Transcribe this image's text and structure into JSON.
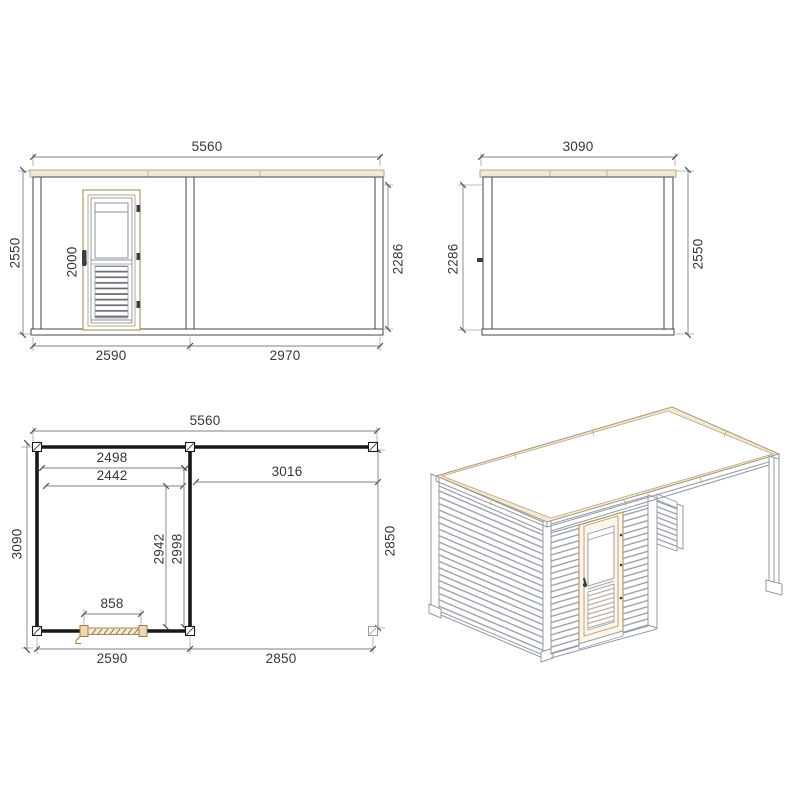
{
  "drawing": {
    "type": "technical-plan-sheet",
    "subject": "garden cabin with side pergola",
    "views": [
      "front-elevation",
      "side-elevation",
      "floor-plan",
      "isometric-view"
    ]
  },
  "front": {
    "width_total": "5560",
    "height_left": "2550",
    "height_right": "2286",
    "door_height": "2000",
    "bottom_left": "2590",
    "bottom_right": "2970"
  },
  "side": {
    "width_total": "3090",
    "height_left": "2286",
    "height_right": "2550"
  },
  "plan": {
    "width_total": "5560",
    "inner_width_1": "2498",
    "inner_width_2": "2442",
    "open_span": "3016",
    "depth_left": "3090",
    "inner_depth_1": "2942",
    "inner_depth_2": "2998",
    "depth_right": "2850",
    "door_width": "858",
    "bottom_left": "2590",
    "bottom_right": "2850"
  },
  "colors": {
    "slat_dark": "#40454b",
    "dimension_text": "#34373c",
    "dimension_line": "#7d828a",
    "wood_tan_fill": "#f1e8d6",
    "wood_tan_stroke": "#b3a077",
    "door_tan": "#b99a6d",
    "plan_wall": "#17181a",
    "iso_line": "#939aa4",
    "background": "#ffffff"
  }
}
